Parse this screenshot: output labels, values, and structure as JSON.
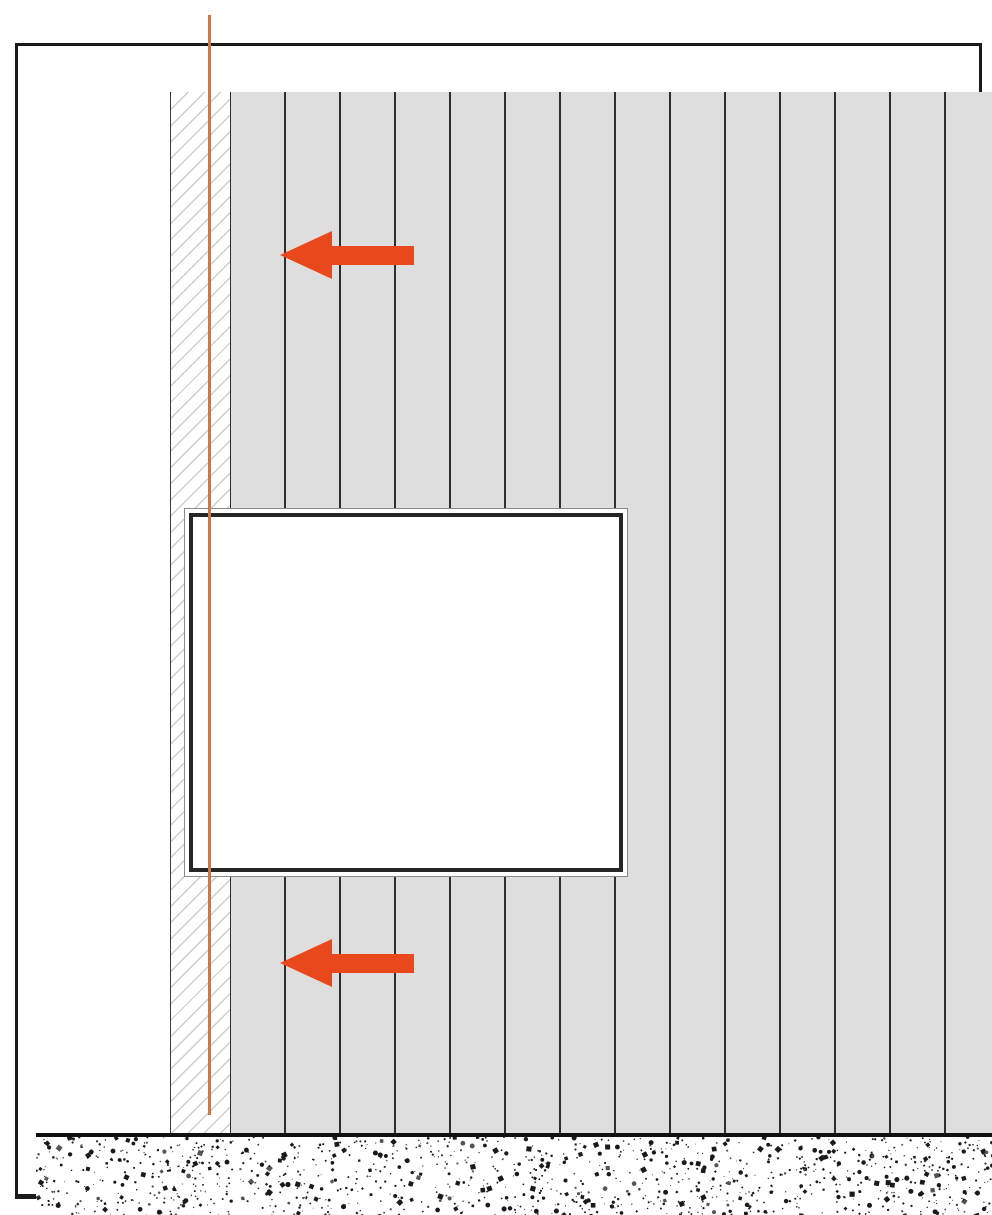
{
  "colors": {
    "frame_border": "#1a1a1a",
    "wall_white": "#ffffff",
    "hatch_line": "#cdcdcd",
    "hatch_border": "#3c3c3c",
    "panel_fill": "#dedede",
    "panel_seam": "#2e2e2e",
    "window_outline": "#8a8a8a",
    "window_frame": "#262626",
    "floor_border": "#111111",
    "floor_bg": "#ffffff",
    "speckle": "#1a1a1a",
    "speckle_light": "#555555",
    "arrow": "#e8481c",
    "plumb_line": "#cc7a45"
  },
  "panels": {
    "seam_count": 13,
    "first_seam_local_x": 53,
    "spacing": 55
  },
  "arrows": [
    {
      "icon": "arrow-left",
      "tip_x": 277,
      "center_y": 252
    },
    {
      "icon": "arrow-left",
      "tip_x": 277,
      "center_y": 960
    }
  ],
  "plumb_line": {
    "x": 208,
    "top": 15,
    "height": 1100,
    "width": 3
  },
  "floor_speckle": {
    "dot_count": 1550,
    "seed": 7,
    "area_w": 961,
    "area_h": 103
  }
}
